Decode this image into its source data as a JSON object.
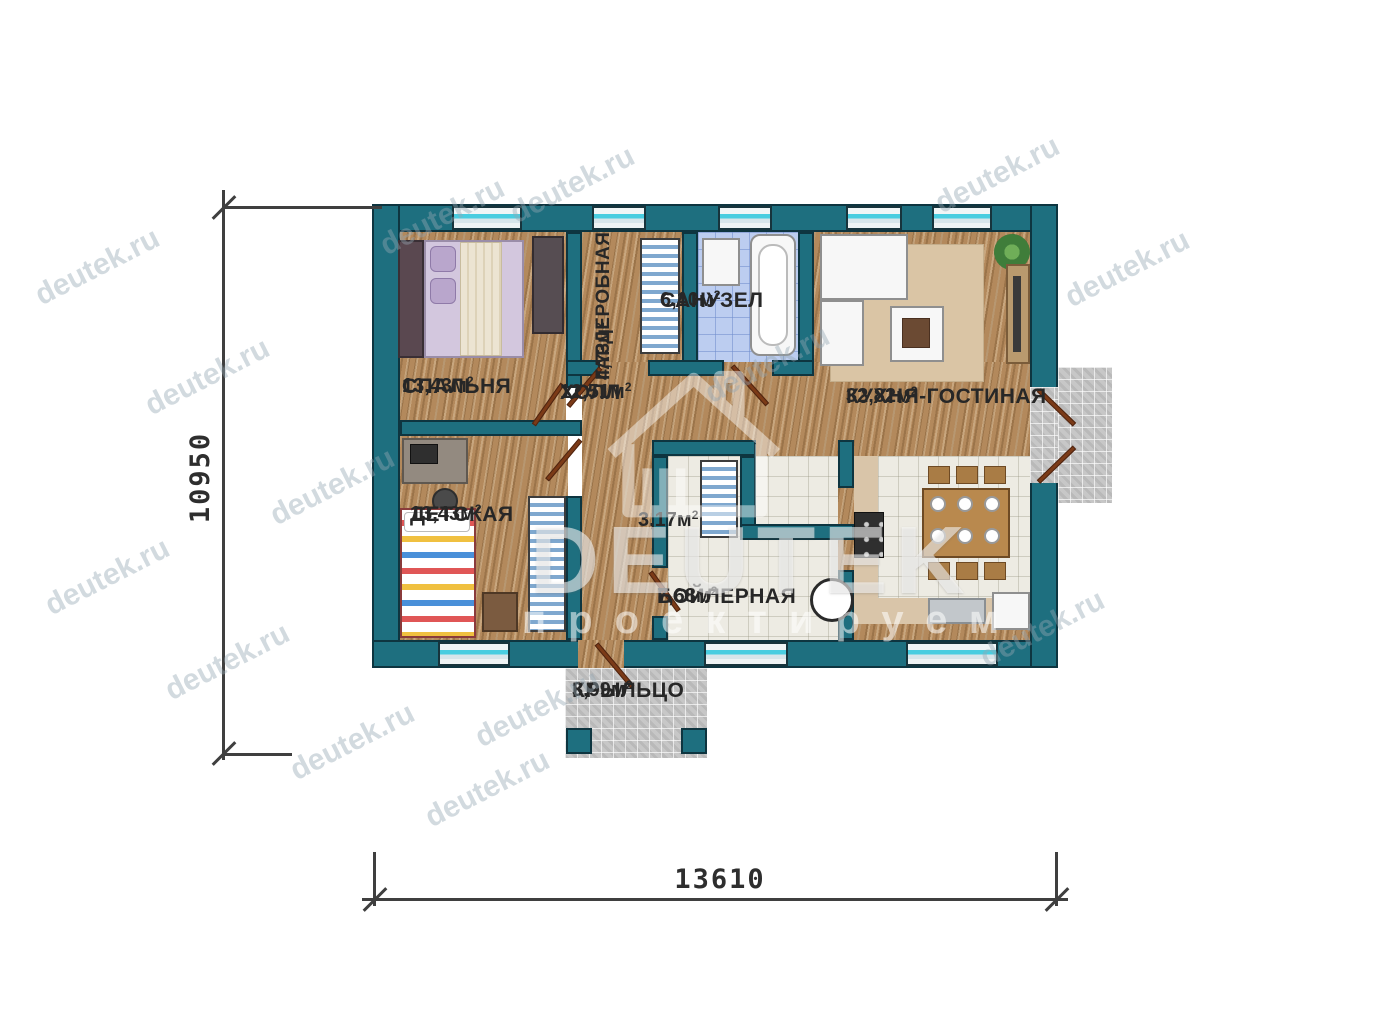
{
  "brand": {
    "logo_text": "DEUTEK",
    "slogan": "проектируем",
    "watermark_url": "deutek.ru"
  },
  "dimensions": {
    "height_mm": "10950",
    "width_mm": "13610"
  },
  "rooms": {
    "bedroom": {
      "name": "СПАЛЬНЯ",
      "area": "13,43м",
      "sup": "2"
    },
    "wardrobe": {
      "name": "ГАРДЕРОБНАЯ",
      "area": "4,73м",
      "sup": "2"
    },
    "bathroom": {
      "name": "САНУЗЕЛ",
      "area": "6,10м",
      "sup": "2"
    },
    "hall": {
      "name": "ХОЛЛ",
      "area": "12,51м",
      "sup": "2"
    },
    "kitchen_living": {
      "name": "КУХНЯ-ГОСТИНАЯ",
      "area": "32,82м",
      "sup": "2"
    },
    "children": {
      "name": "ДЕТСКАЯ",
      "area": "13,43м",
      "sup": "2"
    },
    "corridor": {
      "area": "3,17м",
      "sup": "2"
    },
    "boiler": {
      "name": "БОЙЛЕРНАЯ",
      "area": "7,68м",
      "sup": "2"
    },
    "porch": {
      "name": "КРЫЛЬЦО",
      "area": "3,99м",
      "sup": "2"
    }
  },
  "colors": {
    "wall_teal": "#1E6F7F",
    "wood": "#B3895C",
    "tile_blue": "#BCCDF0",
    "tile_white": "#EDEBE3",
    "paving": "#C7C7C7",
    "window_cyan": "#49CDE0",
    "door_brown": "#7B3A17",
    "label_ink": "#272727"
  }
}
